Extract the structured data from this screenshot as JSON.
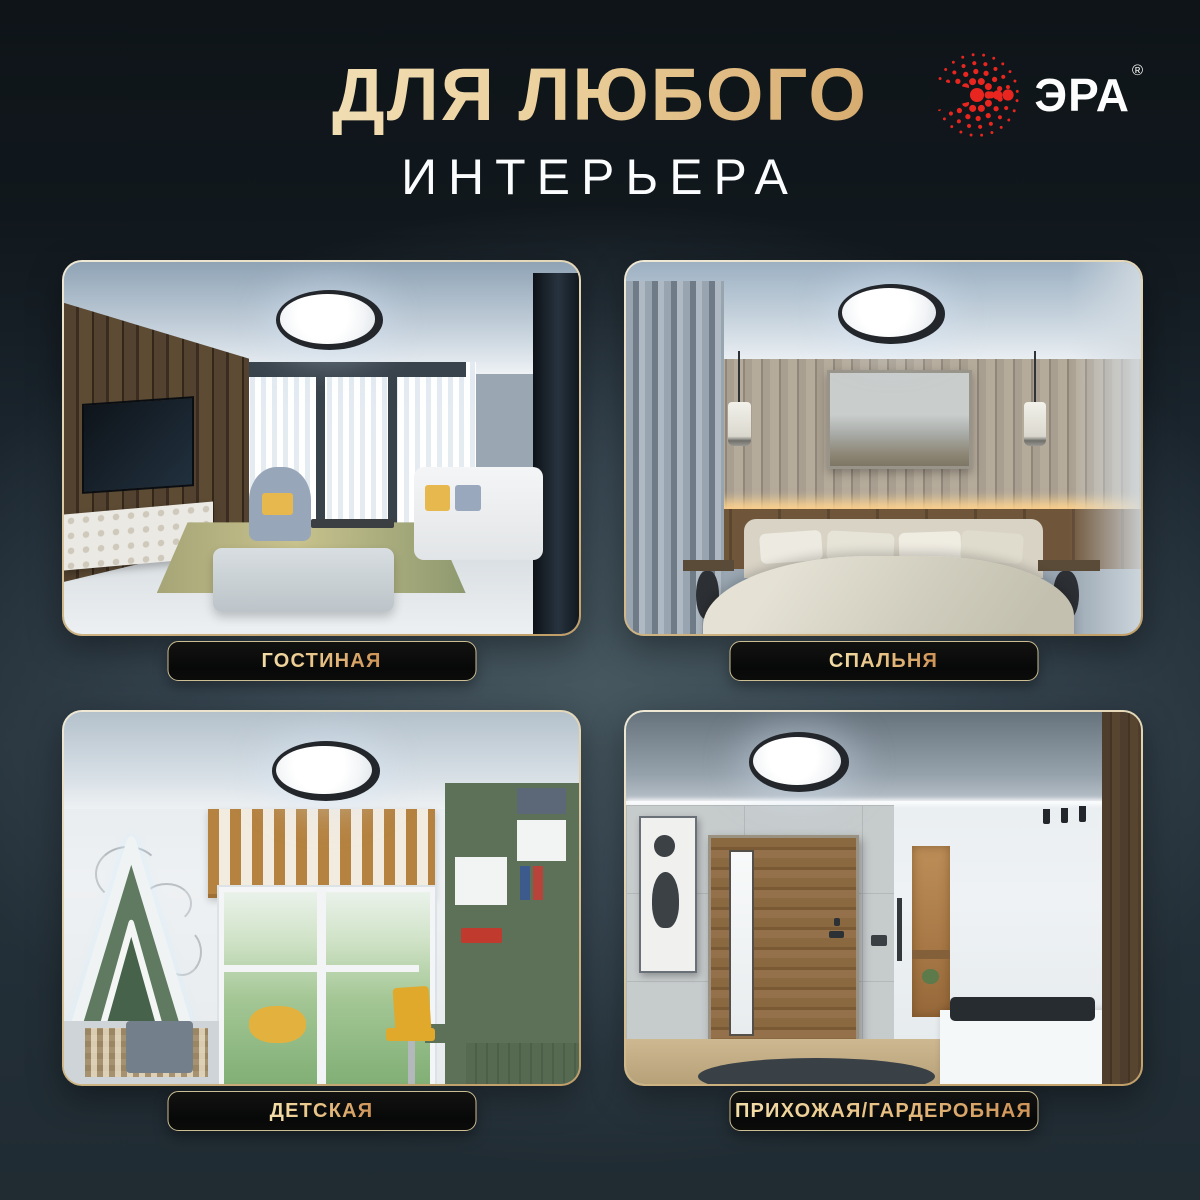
{
  "header": {
    "title_line1": "ДЛЯ ЛЮБОГО",
    "title_line2": "ИНТЕРЬЕРА",
    "title_gold_light": "#f7ecce",
    "title_gold_dark": "#c8904f"
  },
  "brand": {
    "name": "ЭРА",
    "registered_mark": "®",
    "logo_red": "#e8251f"
  },
  "icons": {
    "logo": "era-dotted-sunburst-icon",
    "product": "round-led-ceiling-light"
  },
  "rooms": [
    {
      "id": "living-room",
      "label": "ГОСТИНАЯ"
    },
    {
      "id": "bedroom",
      "label": "СПАЛЬНЯ"
    },
    {
      "id": "kids-room",
      "label": "ДЕТСКАЯ"
    },
    {
      "id": "hallway",
      "label": "ПРИХОЖАЯ/ГАРДЕРОБНАЯ"
    }
  ],
  "colors": {
    "background_top": "#0f1519",
    "background_glow": "#46575f",
    "background_bottom": "#202b32",
    "card_border_light": "#efe9d6",
    "card_border_gold": "#c19e66",
    "label_gold_light": "#f2dca6",
    "label_gold_dark": "#cf9559",
    "label_plate_bg": "#0a0c0c"
  }
}
